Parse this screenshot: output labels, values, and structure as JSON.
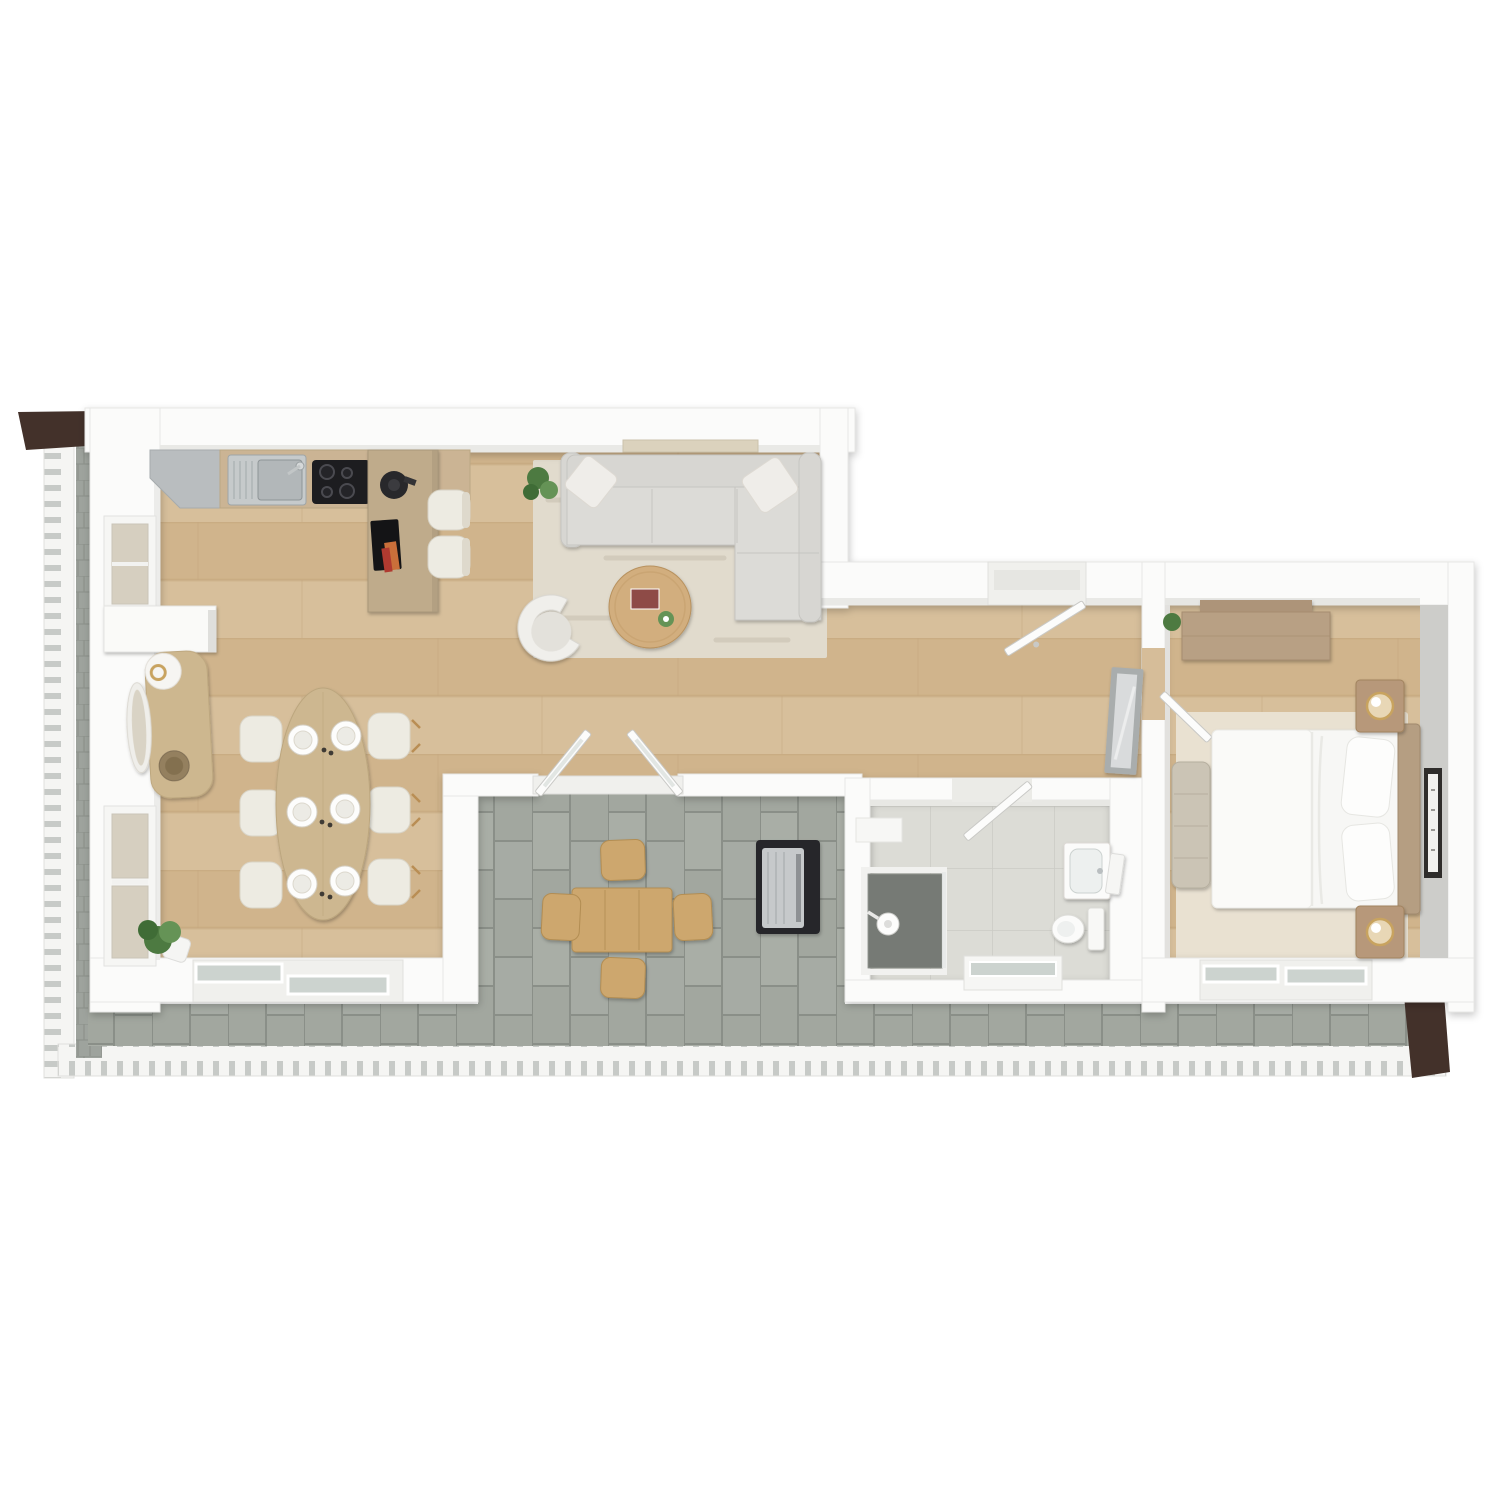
{
  "scene": {
    "type": "3d-floor-plan-top-down-render",
    "description": "One-bedroom apartment 3D floor plan, top view, with open living/kitchen/dining area, hallway, bathroom, bedroom and wrap-around terrace",
    "canvas": {
      "width": 1500,
      "height": 1500
    }
  },
  "rooms": [
    {
      "id": "kitchen",
      "label": "Kitchen"
    },
    {
      "id": "living-room",
      "label": "Living room"
    },
    {
      "id": "dining-area",
      "label": "Dining area"
    },
    {
      "id": "hallway",
      "label": "Hallway"
    },
    {
      "id": "bathroom",
      "label": "Bathroom"
    },
    {
      "id": "bedroom",
      "label": "Bedroom"
    },
    {
      "id": "terrace",
      "label": "Terrace"
    },
    {
      "id": "side-balcony",
      "label": "Side balcony"
    }
  ],
  "furniture": {
    "kitchen": [
      "corner cabinet",
      "counter with stainless sink",
      "induction cooktop",
      "kitchen island",
      "coffee machine",
      "2 bar stools"
    ],
    "living_room": [
      "wall shelf",
      "L-shaped sofa with 2 cushions",
      "area rug",
      "round coffee table",
      "armchair",
      "potted plant"
    ],
    "dining_area": [
      "console with round mirror",
      "oval dining table",
      "6 place settings",
      "6 chairs",
      "potted plant"
    ],
    "hallway": [
      "entry door",
      "leaning floor mirror",
      "bedroom door",
      "bathroom door"
    ],
    "bathroom": [
      "walk-in shower",
      "vanity with basin",
      "toilet",
      "window"
    ],
    "bedroom": [
      "dresser",
      "double bed with duvet and 2 pillows",
      "headboard",
      "2 nightstands with brass lamps",
      "bedside bench",
      "wall picture",
      "area rug",
      "sliding glass door"
    ],
    "terrace": [
      "outdoor dining table",
      "4 outdoor chairs",
      "barbecue grill",
      "perimeter railing",
      "dark privacy panel",
      "awning"
    ]
  },
  "palette": {
    "background": "#ffffff",
    "wall": "#fbfbfa",
    "wall_edge": "#e6e6e3",
    "wall_face": "#cdcdca",
    "wood_floor": "#d7bf9b",
    "wood_floor_alt": "#d0b48c",
    "wood_line": "#c2a67c",
    "terrace_tile": "#a2a79f",
    "terrace_tile_alt": "#a9aea6",
    "terrace_tile_line": "#8a8f88",
    "balcony_tile": "#9ea39d",
    "bath_floor": "#dcdcd6",
    "bath_floor_line": "#cbcbc5",
    "living_rug": "#e1dbcd",
    "bedroom_rug": "#e9e1d1",
    "sofa": "#d7d6d2",
    "sofa_seat": "#dcdbd7",
    "cushion": "#efede9",
    "armchair": "#f0efeb",
    "coffee_table": "#d2ae7e",
    "dining_table": "#cdb790",
    "console_wood": "#cdb78f",
    "chair_cream": "#edebe2",
    "kitchen_counter": "#cbb494",
    "kitchen_island": "#bfab8b",
    "gray_cabinet": "#b9bdbf",
    "steel": "#c6cacb",
    "steel_dark": "#b2b7b9",
    "cooktop": "#1d1d20",
    "coffee_machine": "#28282b",
    "tray_black": "#141416",
    "accent_orange": "#c96f3a",
    "accent_red": "#b03a30",
    "book_red": "#8e4b46",
    "bed_linen": "#f7f7f5",
    "duvet": "#fafaf8",
    "headboard": "#b59e82",
    "nightstand": "#b7987a",
    "dresser": "#b8a084",
    "bench": "#cbc4b5",
    "lamp_gold": "#c8a35f",
    "lamp_shade": "#e8d7b6",
    "frame_dark": "#2f2d2b",
    "mirror_frame": "#a9adad",
    "mirror_glass": "#d9dbdc",
    "bowl_brown": "#94805f",
    "plant_dark": "#3f6c36",
    "plant_green": "#4d7a41",
    "plant_light": "#659356",
    "outdoor_wood": "#cda76e",
    "outdoor_wood_line": "#b28d52",
    "bbq_dark": "#27282b",
    "bbq_steel": "#c6c9cb",
    "awning": "#43312a",
    "railing": "#f5f5f3",
    "railing_slit": "#c2c6c2",
    "glass": "#ccd3cf",
    "window_frame": "#f6f6f4",
    "window_glass": "#d6cfc0",
    "shower_floor": "#767a75",
    "door_leaf": "#fcfcfb",
    "door_edge": "#c9c9c6",
    "threshold": "#f0f0ed"
  }
}
